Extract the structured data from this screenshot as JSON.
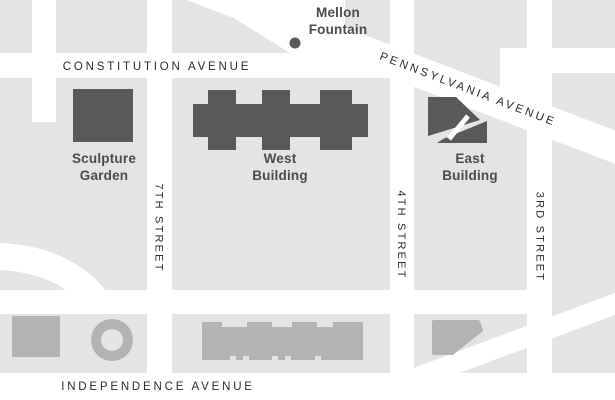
{
  "map": {
    "streets": {
      "constitution": "CONSTITUTION AVENUE",
      "pennsylvania": "PENNSYLVANIA AVENUE",
      "independence": "INDEPENDENCE AVENUE",
      "seventh": "7TH STREET",
      "fourth": "4TH STREET",
      "third": "3RD STREET"
    },
    "landmarks": {
      "mellon": {
        "line1": "Mellon",
        "line2": "Fountain"
      },
      "sculpture_garden": {
        "line1": "Sculpture",
        "line2": "Garden"
      },
      "west_building": {
        "line1": "West",
        "line2": "Building"
      },
      "east_building": {
        "line1": "East",
        "line2": "Building"
      }
    },
    "colors": {
      "block_gray": "#E4E4E4",
      "street_white": "#FFFFFF",
      "building_dark": "#59595B",
      "building_medium": "#B3B3B3",
      "street_label": "#2B2B2B",
      "building_label": "#4A4A4A"
    }
  }
}
